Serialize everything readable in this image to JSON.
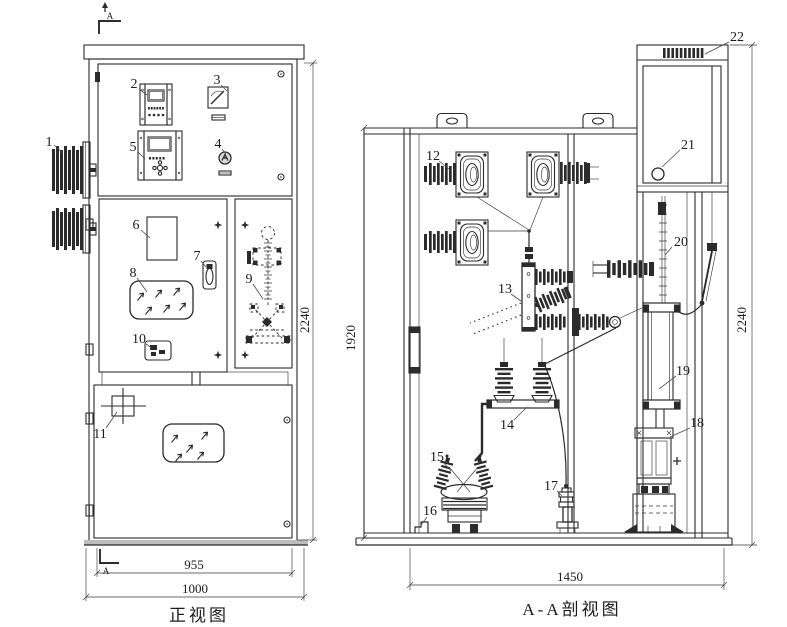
{
  "drawing": {
    "front_view": {
      "caption": "正视图",
      "section_marker": "A",
      "dim_height": "2240",
      "dim_panel_width": "955",
      "dim_width": "1000"
    },
    "section_view": {
      "caption": "A-A剖视图",
      "dim_inner_height": "1920",
      "dim_height": "2240",
      "dim_depth": "1450"
    },
    "part_labels": {
      "p1": "1",
      "p2": "2",
      "p3": "3",
      "p4": "4",
      "p5": "5",
      "p6": "6",
      "p7": "7",
      "p8": "8",
      "p9": "9",
      "p10": "10",
      "p11": "11",
      "p12": "12",
      "p13": "13",
      "p14": "14",
      "p15": "15",
      "p16": "16",
      "p17": "17",
      "p18": "18",
      "p19": "19",
      "p20": "20",
      "p21": "21",
      "p22": "22"
    },
    "colors": {
      "ink": "#2b2b2b",
      "paper": "#ffffff"
    }
  }
}
